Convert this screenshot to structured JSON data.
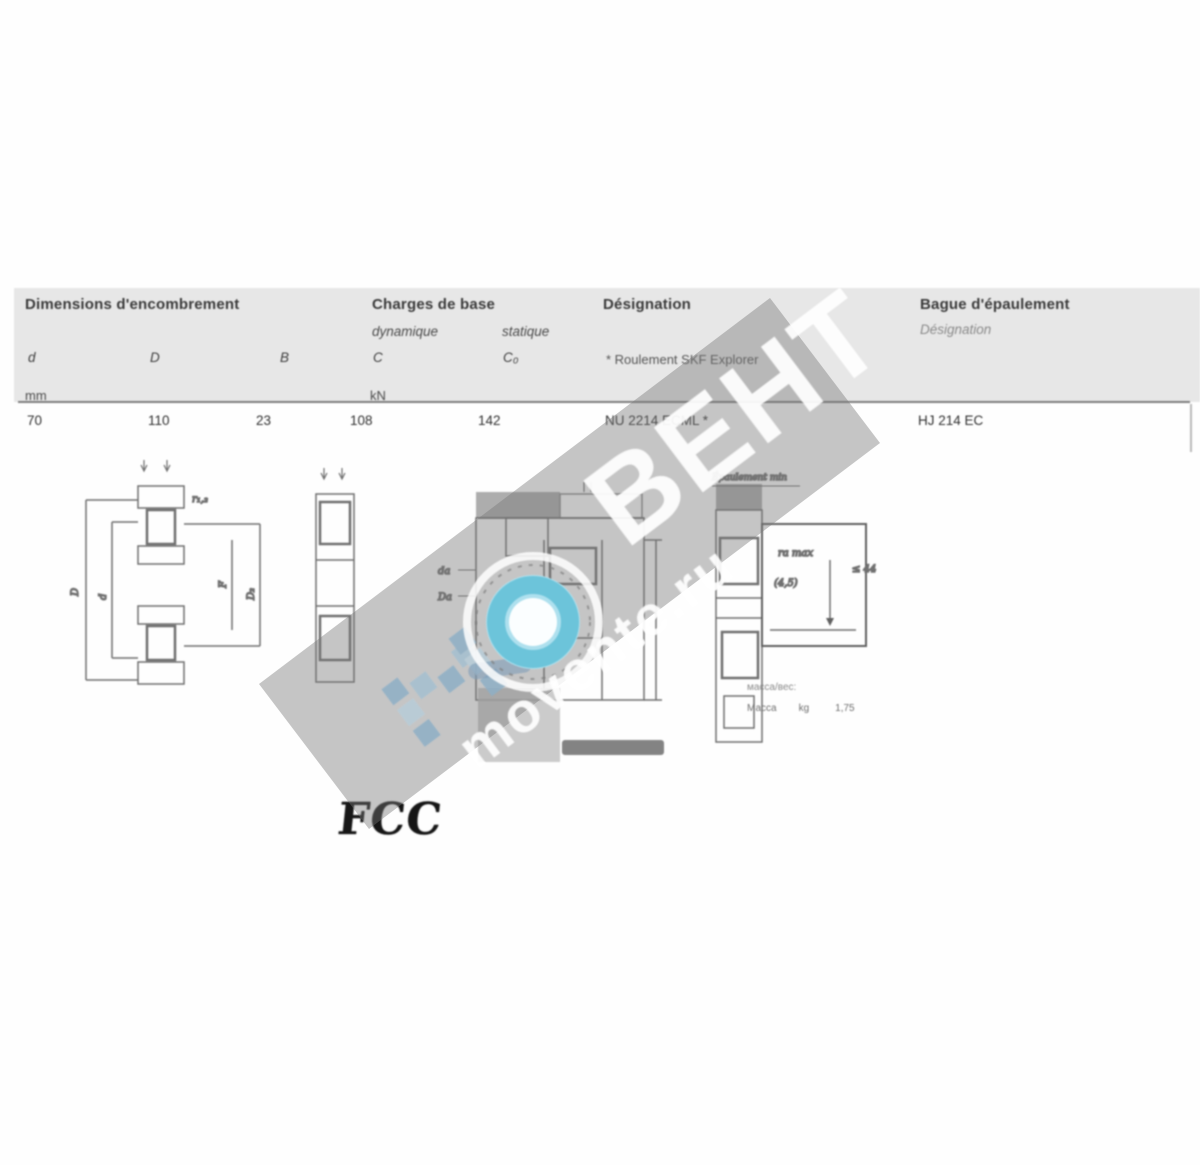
{
  "colors": {
    "header_bg": "#e7e7e7",
    "watermark_band": "#767676",
    "ring_teal": "#79c7dd",
    "logo_blue": "#8fb0c6"
  },
  "table": {
    "header": {
      "dimensions_title": "Dimensions d'encombrement",
      "loads_title": "Charges de base",
      "loads_dynamic": "dynamique",
      "loads_static": "statique",
      "sym_d": "d",
      "sym_D": "D",
      "sym_B": "B",
      "sym_C": "C",
      "sym_C0": "C₀",
      "unit_mm": "mm",
      "unit_kN": "kN",
      "designation_title": "Désignation",
      "designation_note": "* Roulement SKF Explorer",
      "ring_title": "Bague d'épaulement",
      "ring_subtitle": "Désignation"
    },
    "row": {
      "d": "70",
      "D": "110",
      "B": "23",
      "C": "108",
      "C0": "142",
      "designation": "NU 2214 ECML *",
      "ring": "HJ 214 EC"
    }
  },
  "drawings": {
    "left": {
      "r12": "r₁,₂",
      "D": "D",
      "d": "d",
      "F": "F",
      "D2": "D₂"
    },
    "center": {
      "da": "da",
      "Da": "Da"
    },
    "right": {
      "top_label": "Épaulement min",
      "ra": "ra max",
      "chamfer": "(4,5)",
      "side": "≤ 44"
    }
  },
  "caption": {
    "line1": "масса/вес:",
    "mass_label": "Масса",
    "mass_unit": "kg",
    "mass_value": "1,75"
  },
  "watermark": {
    "brand": "BEHT",
    "site": "movente.ru"
  },
  "logo": {
    "brand": "FCC"
  }
}
